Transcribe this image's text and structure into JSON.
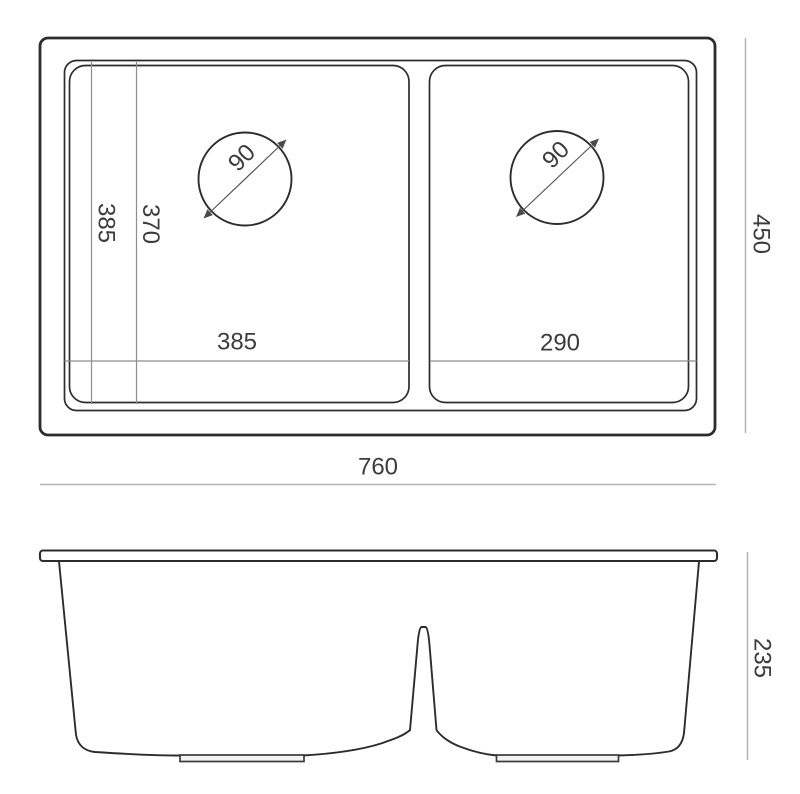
{
  "colors": {
    "background": "#ffffff",
    "line": "#2c2c2c",
    "helper": "#8d8d8d",
    "dim": "#b3b3b3",
    "text": "#3c3c3c"
  },
  "top_view": {
    "overall_width": "760",
    "overall_depth": "450",
    "left_bowl_width": "385",
    "right_bowl_width": "290",
    "bowl_depth_outer": "385",
    "bowl_depth_inner": "370",
    "left_drain_diameter": "90",
    "right_drain_diameter": "90"
  },
  "front_view": {
    "overall_height": "235"
  }
}
